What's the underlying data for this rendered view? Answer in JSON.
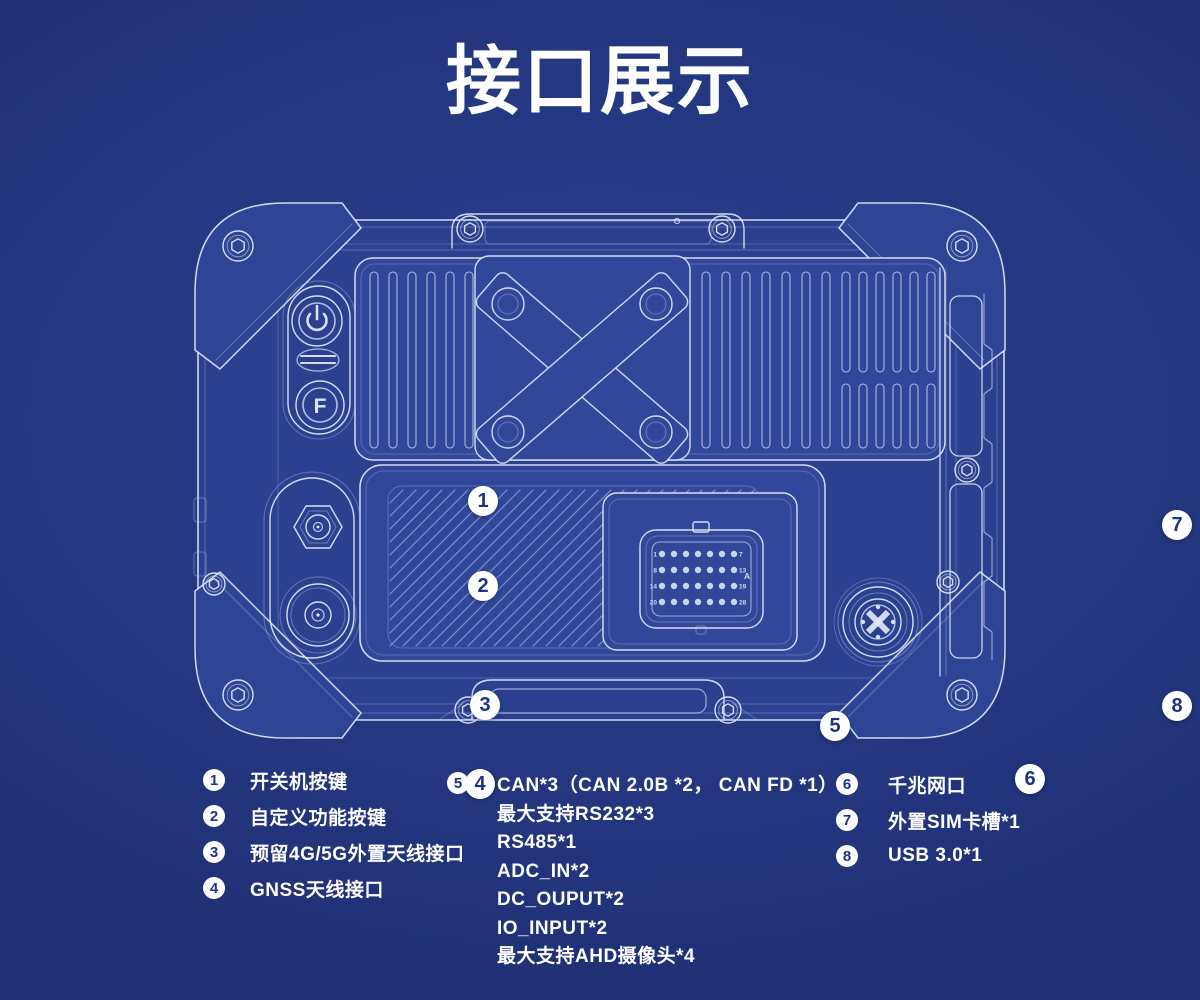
{
  "title": "接口展示",
  "colors": {
    "background": "#233781",
    "panel_fill": "#31489a",
    "line": "#e3ebfa",
    "text": "#ffffff",
    "badge_background": "#ffffff",
    "badge_number": "#1e3383"
  },
  "device": {
    "f_button_label": "F",
    "connector": {
      "pin_labels": [
        "1",
        "7",
        "8",
        "13",
        "14",
        "19",
        "20",
        "28"
      ],
      "zone_label": "A"
    }
  },
  "callouts": [
    {
      "num": "1"
    },
    {
      "num": "2"
    },
    {
      "num": "3"
    },
    {
      "num": "4"
    },
    {
      "num": "5"
    },
    {
      "num": "6"
    },
    {
      "num": "7"
    },
    {
      "num": "8"
    }
  ],
  "legend": {
    "column1": [
      {
        "num": "1",
        "label": "开关机按键"
      },
      {
        "num": "2",
        "label": "自定义功能按键"
      },
      {
        "num": "3",
        "label": "预留4G/5G外置天线接口"
      },
      {
        "num": "4",
        "label": "GNSS天线接口"
      }
    ],
    "column2": [
      {
        "num": "5",
        "lines": [
          "CAN*3（CAN 2.0B *2， CAN FD *1）",
          "最大支持RS232*3",
          "RS485*1",
          "ADC_IN*2",
          "DC_OUPUT*2",
          "IO_INPUT*2",
          "最大支持AHD摄像头*4"
        ]
      }
    ],
    "column3": [
      {
        "num": "6",
        "label": "千兆网口"
      },
      {
        "num": "7",
        "label": "外置SIM卡槽*1"
      },
      {
        "num": "8",
        "label": "USB 3.0*1"
      }
    ]
  }
}
